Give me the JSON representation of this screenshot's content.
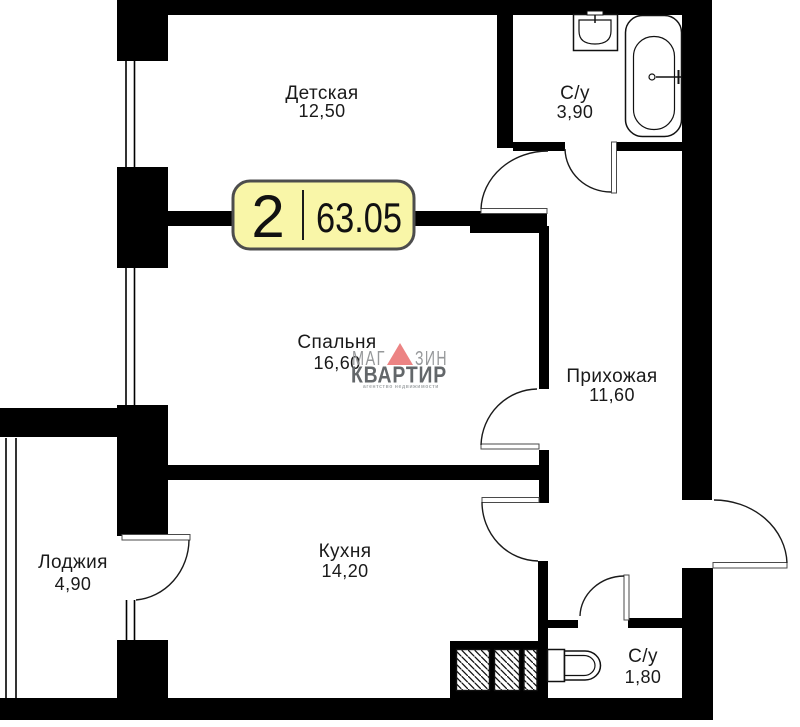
{
  "plan": {
    "badge": {
      "rooms_count": "2",
      "total_area": "63.05"
    },
    "rooms": [
      {
        "id": "detskaya",
        "name": "Детская",
        "area": "12,50"
      },
      {
        "id": "bathroom-large",
        "name": "С/у",
        "area": "3,90"
      },
      {
        "id": "bedroom",
        "name": "Спальня",
        "area": "16,60"
      },
      {
        "id": "hallway",
        "name": "Прихожая",
        "area": "11,60"
      },
      {
        "id": "loggia",
        "name": "Лоджия",
        "area": "4,90"
      },
      {
        "id": "kitchen",
        "name": "Кухня",
        "area": "14,20"
      },
      {
        "id": "bathroom-small",
        "name": "С/у",
        "area": "1,80"
      }
    ],
    "watermark": {
      "word1_part1": "МАГ",
      "word1_part2": "ЗИН",
      "word2": "КВАРТИР",
      "tagline": "агентство недвижимости"
    },
    "icons": {
      "bathtub": "bathtub-outline-shape",
      "sink": "sink-outline-shape",
      "toilet": "toilet-outline-shape",
      "vent_shaft": "diagonal-hatch-box",
      "door": "quarter-arc-swing",
      "window": "double-line"
    },
    "colors": {
      "wall": "#000000",
      "badge_fill": "#f9f6a8",
      "badge_border": "#4d4d4d",
      "watermark_gray": "#96989a",
      "watermark_dark": "#63676a",
      "watermark_tagline": "#a5a9ab",
      "watermark_accent": "#ec8383"
    }
  }
}
